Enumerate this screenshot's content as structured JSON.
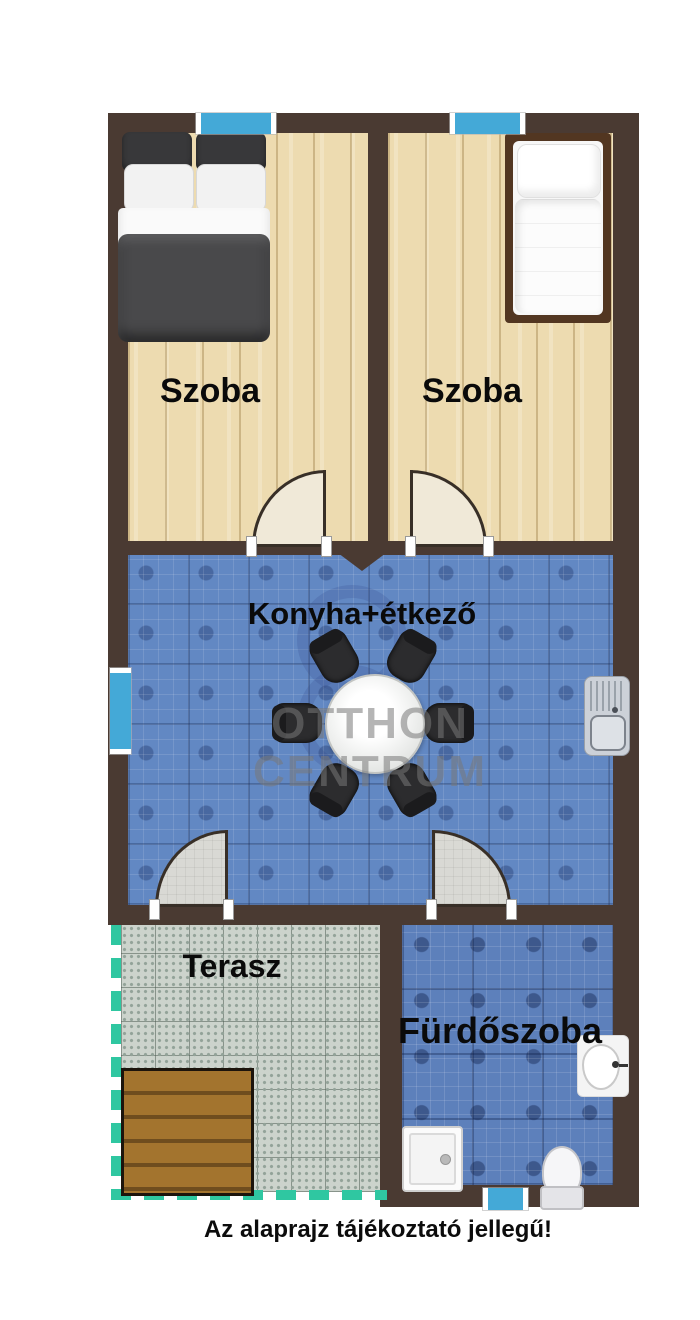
{
  "note": {
    "text": "Az alaprajz tájékoztató jellegű!"
  },
  "rooms": {
    "bedroom1": {
      "label": "Szoba"
    },
    "bedroom2": {
      "label": "Szoba"
    },
    "kitchen": {
      "label": "Konyha+étkező"
    },
    "terrace": {
      "label": "Terasz"
    },
    "bathroom": {
      "label": "Fürdőszoba"
    }
  },
  "watermark": {
    "line1": "OTTHON",
    "line2": "CENTRUM"
  },
  "fixtures": [
    "double-bed",
    "single-bed",
    "dining-table",
    "dining-chair",
    "kitchen-sink",
    "washbasin",
    "shower-tray",
    "toilet",
    "wood-deck",
    "window",
    "door-swing"
  ],
  "colors": {
    "wall": "#4a3a32",
    "window_glass": "#44a9d7",
    "wood_floor": "#eddbb0",
    "kitchen_tile": "#6288c3",
    "bathroom_tile": "#5d80bb",
    "terrace_tile": "#ccd3cc",
    "deck": "#a3742e",
    "terrace_border": "#2fc7a1",
    "label_text": "#0a0a0a"
  }
}
